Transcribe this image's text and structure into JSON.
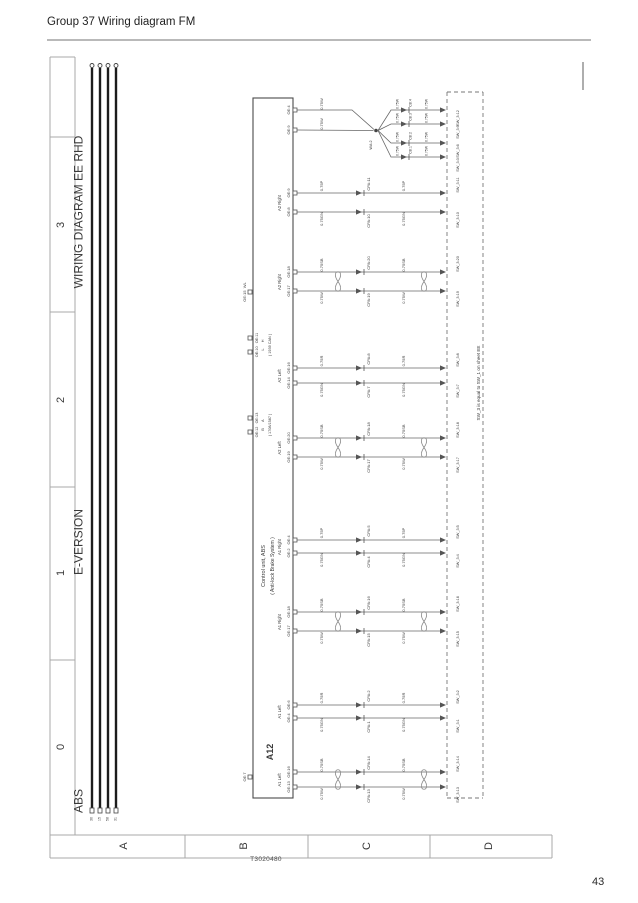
{
  "page": {
    "header": "Group 37 Wiring diagram FM",
    "page_number": "43",
    "figure_id": "T3020480"
  },
  "frame": {
    "row_labels": [
      "3",
      "2",
      "1",
      "0"
    ],
    "col_labels": [
      "A",
      "B",
      "C",
      "D"
    ]
  },
  "titles": [
    {
      "n": "title-wiring-diagram",
      "t": "WIRING DIAGRAM EE RHD",
      "x": 80,
      "y": 212,
      "fs": 12
    },
    {
      "n": "title-e-version",
      "t": "E-VERSION",
      "x": 80,
      "y": 542,
      "fs": 12
    },
    {
      "n": "title-abs",
      "t": "ABS",
      "x": 80,
      "y": 801,
      "fs": 12
    }
  ],
  "unit": {
    "id": "A12",
    "name": "Control unit, ABS",
    "name2": "( Anti-lock Brake System )"
  },
  "bus": {
    "terminals": [
      "30",
      "15",
      "58",
      "31"
    ]
  },
  "note": {
    "t": "SW_3 is equal to SW_1 on sheet EE",
    "x": 479,
    "y": 383
  },
  "power": {
    "pins": [
      "OE:4",
      "OE:9"
    ],
    "wire": "0.75W",
    "junction": "WA:2",
    "branches": [
      {
        "conn": "CB:4",
        "sw": "SW_3:12"
      },
      {
        "conn": "CB:3",
        "sw": "SW_3:9"
      },
      {
        "conn": "CB:2",
        "sw": "SW_3:6"
      },
      {
        "conn": "CB:1",
        "sw": "SW_3:3"
      }
    ]
  },
  "groups": [
    {
      "label": "A2 Right",
      "yt": 193,
      "yb": 212,
      "twisted": false,
      "top": {
        "pin": "OE:9",
        "w": "0.75P",
        "conn": "CPA:11",
        "sw": "SW_3:11"
      },
      "bottom": {
        "pin": "OE:8",
        "w": "0.75GN",
        "conn": "CPA:10",
        "sw": "SW_3:10"
      }
    },
    {
      "label": "A2 Right",
      "yt": 272,
      "yb": 291,
      "twisted": true,
      "top": {
        "pin": "OE:18",
        "w": "0.75SB",
        "conn": "CPA:20",
        "sw": "SW_3:20"
      },
      "bottom": {
        "pin": "OE:17",
        "w": "0.75W",
        "conn": "CPA:19",
        "sw": "SW_3:19"
      }
    },
    {
      "label": "A2 Left",
      "yt": 368,
      "yb": 383,
      "twisted": false,
      "top": {
        "pin": "OE:16",
        "w": "0.75R",
        "conn": "CPA:8",
        "sw": "SW_3:8"
      },
      "bottom": {
        "pin": "OE:14",
        "w": "0.75GN",
        "conn": "CPA:7",
        "sw": "SW_3:7"
      }
    },
    {
      "label": "A2 Left",
      "yt": 438,
      "yb": 457,
      "twisted": true,
      "top": {
        "pin": "OE:20",
        "w": "0.75SB",
        "conn": "CPA:18",
        "sw": "SW_3:18"
      },
      "bottom": {
        "pin": "OE:19",
        "w": "0.75W",
        "conn": "CPA:17",
        "sw": "SW_3:17"
      }
    },
    {
      "label": "A1 Right",
      "yt": 540,
      "yb": 553,
      "twisted": false,
      "top": {
        "pin": "OE:4",
        "w": "0.75P",
        "conn": "CPA:5",
        "sw": "SW_3:5"
      },
      "bottom": {
        "pin": "OE:2",
        "w": "0.75GN",
        "conn": "CPA:4",
        "sw": "SW_3:4"
      }
    },
    {
      "label": "A1 Right",
      "yt": 612,
      "yb": 631,
      "twisted": true,
      "top": {
        "pin": "OE:18",
        "w": "0.75SB",
        "conn": "CPA:16",
        "sw": "SW_3:16"
      },
      "bottom": {
        "pin": "OE:17",
        "w": "0.75W",
        "conn": "CPA:15",
        "sw": "SW_3:15"
      }
    },
    {
      "label": "A1 Left",
      "yt": 705,
      "yb": 718,
      "twisted": false,
      "top": {
        "pin": "OE:6",
        "w": "0.75R",
        "conn": "CPA:2",
        "sw": "SW_3:2"
      },
      "bottom": {
        "pin": "OE:4",
        "w": "0.75GN",
        "conn": "CPA:1",
        "sw": "SW_3:1"
      }
    },
    {
      "label": "A1 Left",
      "yt": 772,
      "yb": 787,
      "twisted": true,
      "top": {
        "pin": "OE:16",
        "w": "0.75SB",
        "conn": "CPA:14",
        "sw": "SW_3:14"
      },
      "bottom": {
        "pin": "OE:13",
        "w": "0.75W",
        "conn": "CPA:13",
        "sw": "SW_3:13"
      }
    }
  ],
  "data_links": [
    {
      "pins": "OE:10   OE:11",
      "signals": "L      H",
      "name": "( 1939 CAN )",
      "y1": 338,
      "y2": 352
    },
    {
      "pins": "OE:12   OE:13",
      "signals": "B      A",
      "name": "( 1708/1587 )",
      "y1": 418,
      "y2": 432
    }
  ],
  "misc_pins": [
    {
      "label": "OE:15  WL",
      "y": 292
    },
    {
      "label": "OE:7",
      "y": 777
    }
  ]
}
